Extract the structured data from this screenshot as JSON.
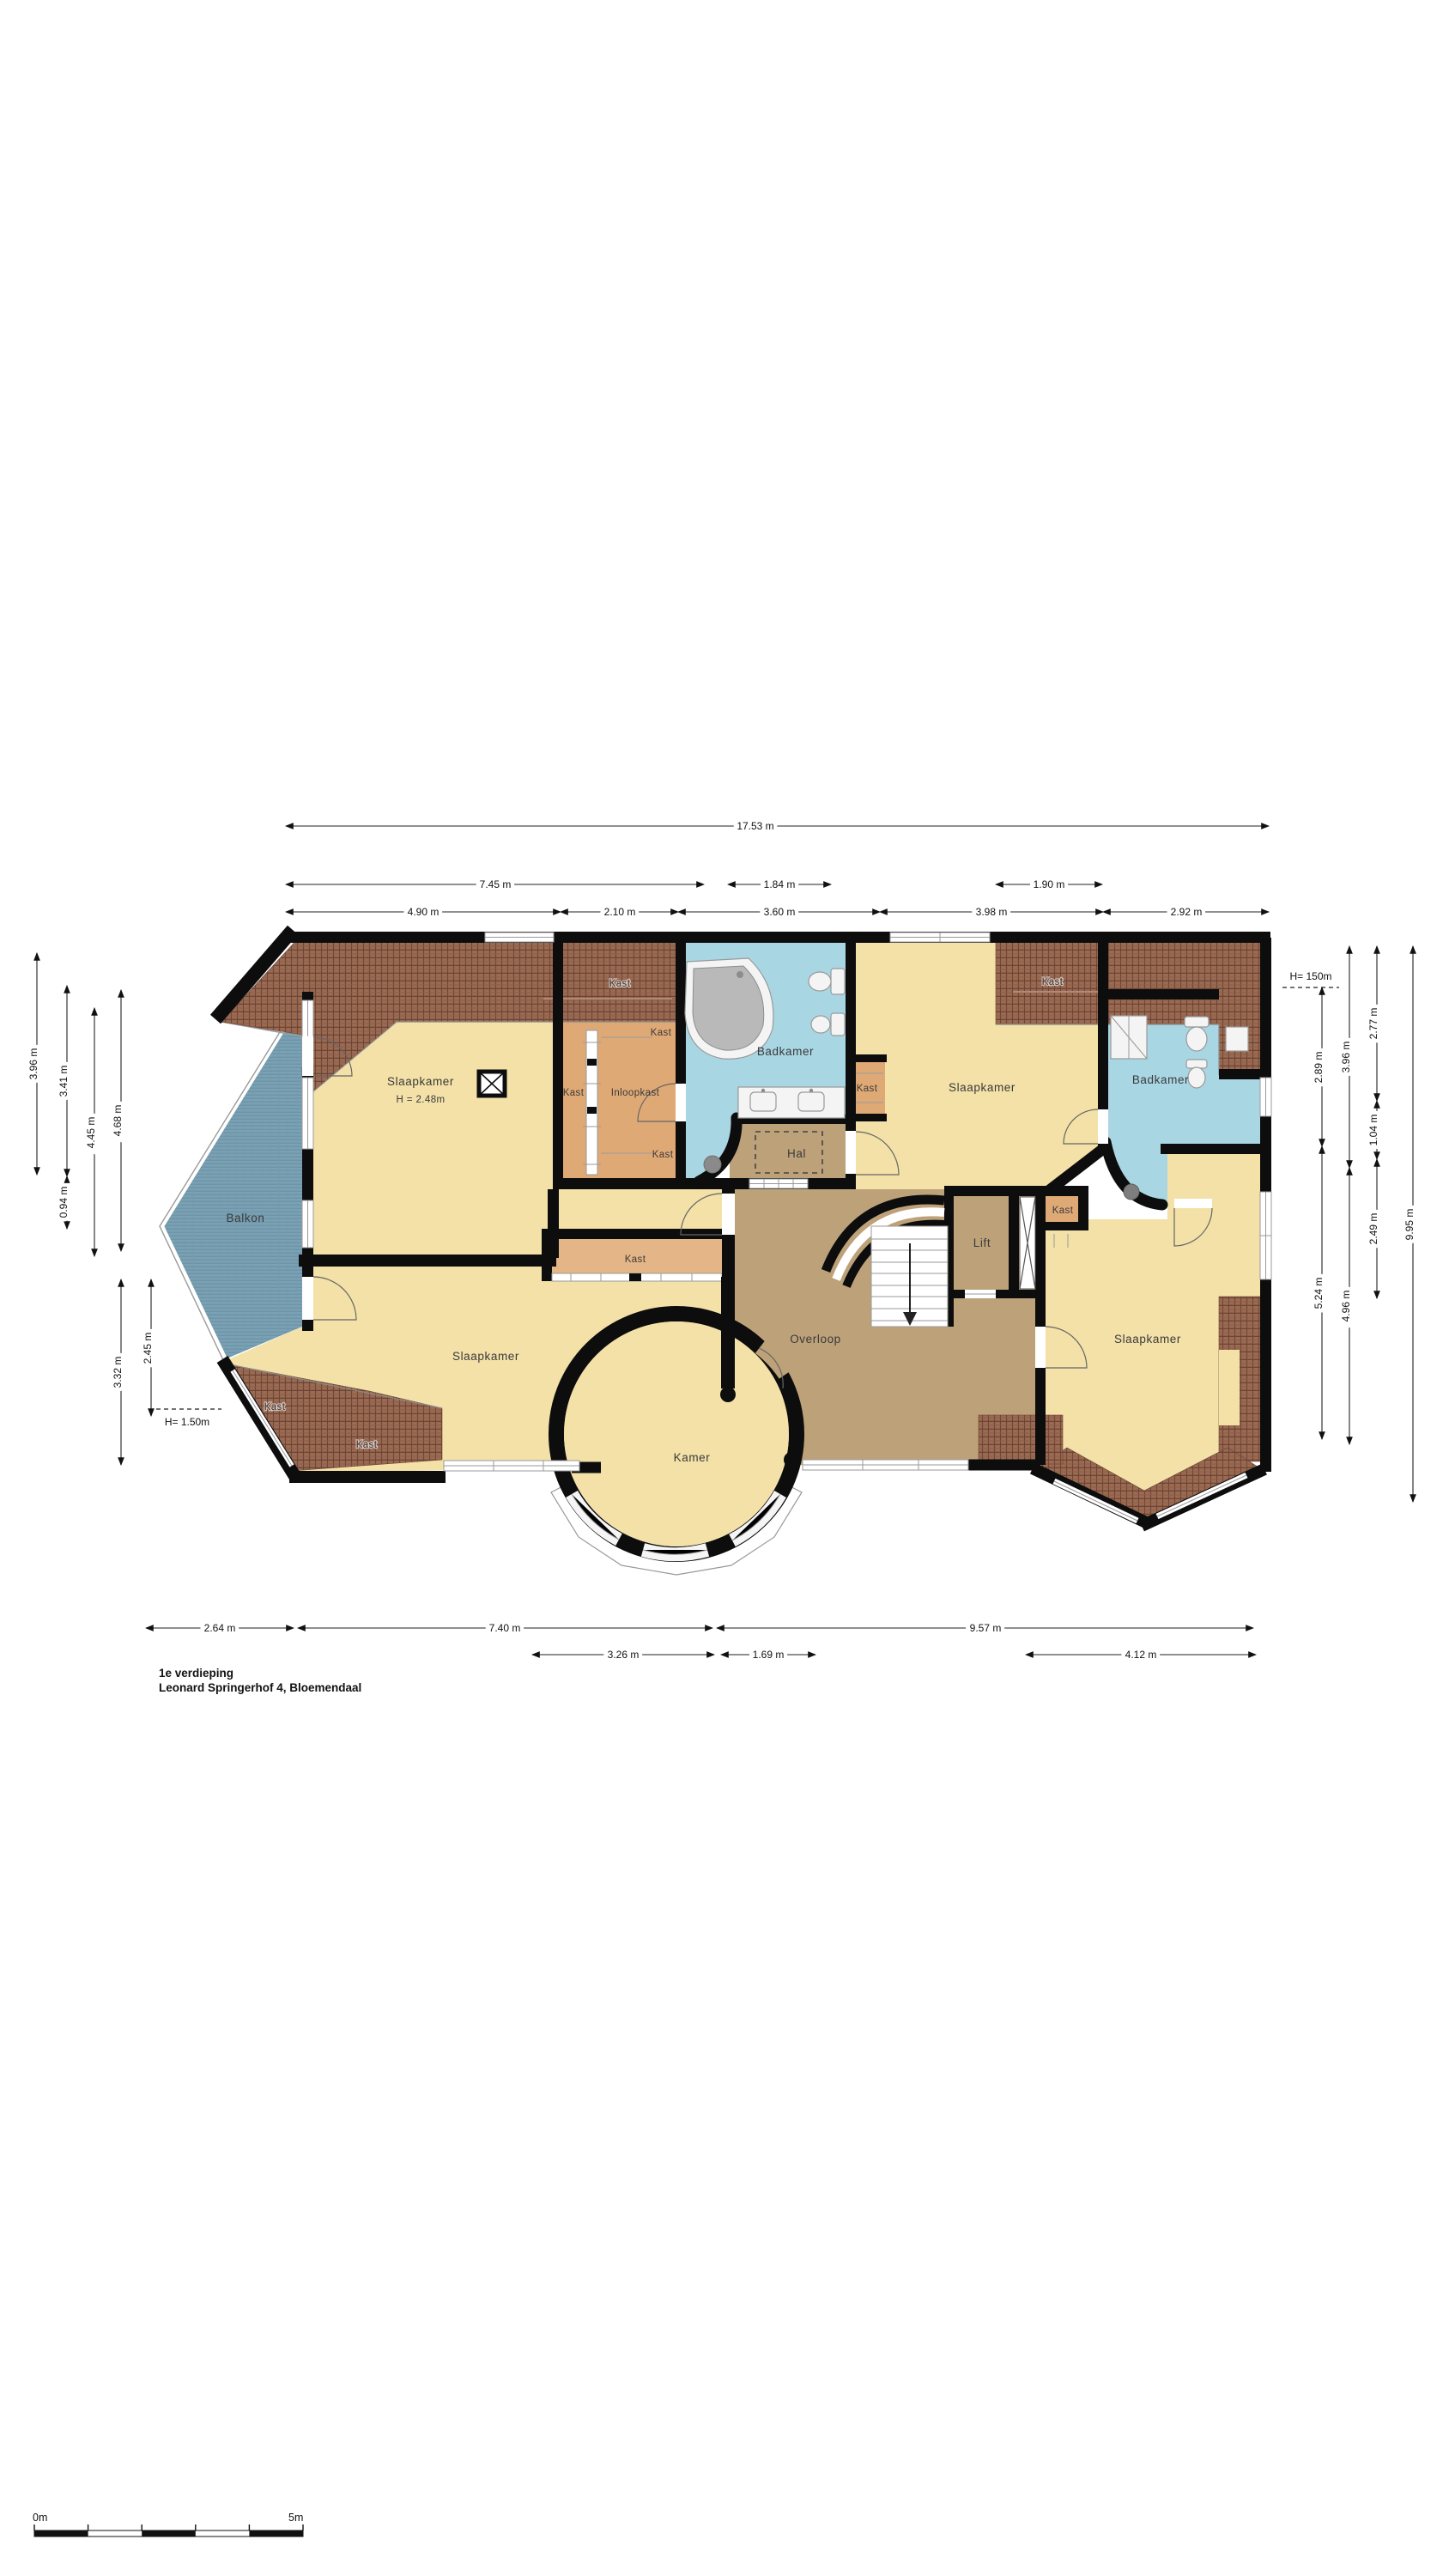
{
  "title": {
    "floor": "1e verdieping",
    "address": "Leonard Springerhof 4, Bloemendaal"
  },
  "labels": {
    "slaapkamer": "Slaapkamer",
    "slaapkamer_height": "H = 2.48m",
    "badkamer": "Badkamer",
    "kast": "Kast",
    "inloopkast": "Inloopkast",
    "hal": "Hal",
    "lift": "Lift",
    "overloop": "Overloop",
    "kamer": "Kamer",
    "balkon": "Balkon"
  },
  "dimensions": {
    "top_total": "17.53 m",
    "top_745": "7.45 m",
    "top_184": "1.84 m",
    "top_190": "1.90 m",
    "top_490": "4.90 m",
    "top_210": "2.10 m",
    "top_360": "3.60 m",
    "top_398": "3.98 m",
    "top_292": "2.92 m",
    "left_396": "3.96 m",
    "left_341": "3.41 m",
    "left_094": "0.94 m",
    "left_445": "4.45 m",
    "left_468": "4.68 m",
    "left_332": "3.32 m",
    "left_245": "2.45 m",
    "left_height": "H= 1.50m",
    "right_height": "H= 150m",
    "right_289": "2.89 m",
    "right_524": "5.24 m",
    "right_396": "3.96 m",
    "right_496": "4.96 m",
    "right_277": "2.77 m",
    "right_104": "1.04 m",
    "right_249": "2.49 m",
    "right_995": "9.95 m",
    "bottom_264": "2.64 m",
    "bottom_740": "7.40 m",
    "bottom_957": "9.57 m",
    "bottom_326": "3.26 m",
    "bottom_169": "1.69 m",
    "bottom_412": "4.12 m"
  },
  "scalebar": {
    "start": "0m",
    "end": "5m"
  },
  "colors": {
    "room_yellow": "#f3e1a8",
    "bathroom_blue": "#a9d6e3",
    "landing_tan": "#bda179",
    "closet_orange": "#dfa976",
    "roof_brown": "#9a6a52",
    "balcony_blue": "#7aa2b4",
    "wall_black": "#0d0d0d"
  }
}
